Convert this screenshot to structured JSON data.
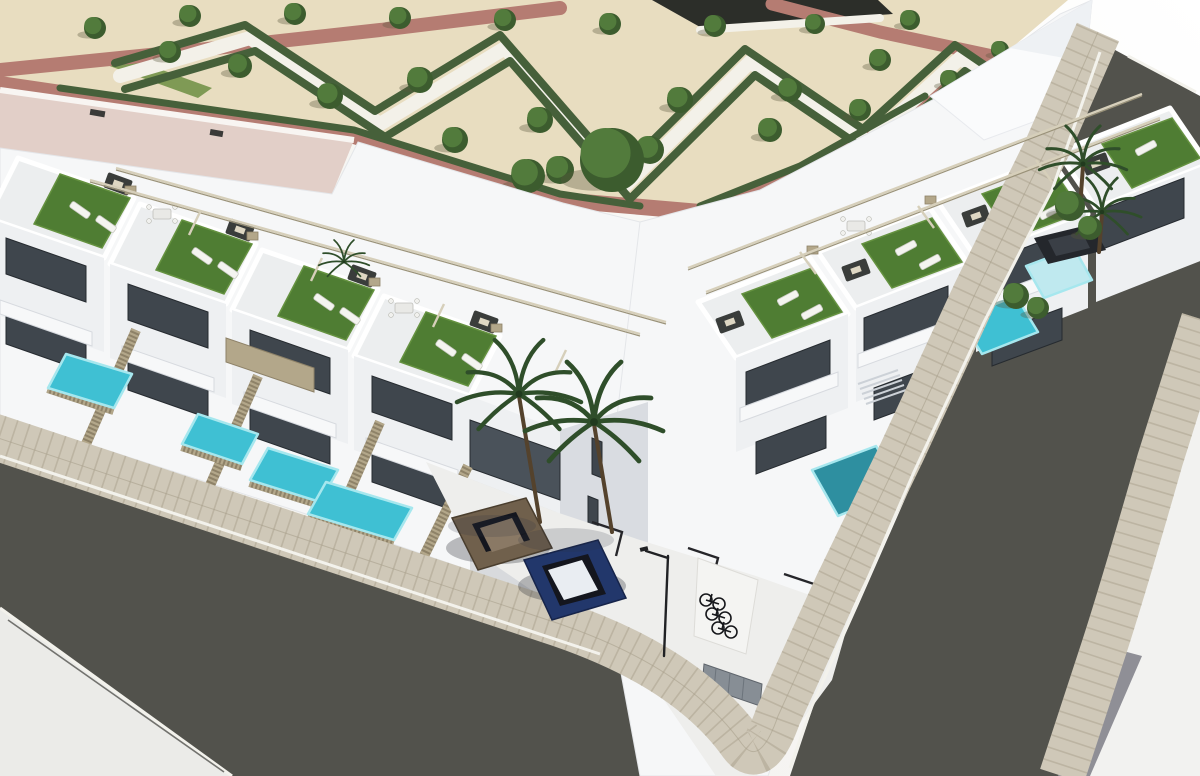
{
  "scene": {
    "type": "architectural-3d-render",
    "setting": "Aerial 3D rendering of a modern white residential complex on a street corner: two-storey townhouses with rooftop terraces, artificial turf, sun loungers and lounge sofas, private plunge pools behind tan slatted fences, a parking court with two cars and a bicycle rack, palm trees, and a landscaped sand-colored park with zigzag hedges, trees and red walking paths. Two asphalt streets with tiled sidewalks meet at the corner.",
    "counts": {
      "rooftop_terraces": 8,
      "pools": 7,
      "cars": 3,
      "palm_trees": 4,
      "bicycles": 3,
      "street_lamps": 1,
      "park_trees": 26
    },
    "objects": [
      "park",
      "zigzag-hedges",
      "red-paths",
      "park-trees",
      "pink-roof-building",
      "left-townhouse-row",
      "right-townhouse-row",
      "corner-building",
      "rooftop-terraces",
      "turf-patches",
      "sun-loungers",
      "lounge-sofas",
      "dining-sets",
      "pergola-rails",
      "private-pools",
      "slatted-fences",
      "balconies",
      "windows",
      "parking-court",
      "parking-markings",
      "blue-car",
      "bronze-car",
      "dark-car",
      "bicycle-rack",
      "street-lamp",
      "left-street",
      "right-street",
      "tiled-sidewalks",
      "corner-sidewalk",
      "palm-trees",
      "street-shrubs"
    ],
    "paths": [
      {
        "p": "0,70 180,52 380,30 560,8",
        "w": 14,
        "cls": "park-path-red"
      },
      {
        "p": "0,84 354,136 560,200 700,212 800,172 928,102 1004,56",
        "w": 16,
        "cls": "park-path-red"
      },
      {
        "p": "772,4 880,32 1002,58",
        "w": 13,
        "cls": "park-path-red"
      },
      {
        "p": "120,76 250,38 380,124 505,48 625,186 750,62 868,142 960,58 1010,92",
        "w": 14,
        "cls": "park-path-white"
      },
      {
        "p": "700,30 880,18",
        "w": 8,
        "cls": "park-path-white"
      }
    ],
    "hedges": [
      {
        "p": "115,63 245,25 375,111 500,35 620,173 745,49 863,129 955,45 1005,79",
        "w": 8
      },
      {
        "p": "125,89 255,51 385,137 510,61 630,199 755,75 873,155 965,71 1015,105",
        "w": 8
      },
      {
        "p": "60,88 354,130 560,194 640,206",
        "w": 7
      },
      {
        "p": "700,206 800,166 925,96",
        "w": 7
      }
    ],
    "trees": [
      [
        95,
        28,
        11
      ],
      [
        190,
        16,
        11
      ],
      [
        295,
        14,
        11
      ],
      [
        400,
        18,
        11
      ],
      [
        505,
        20,
        11
      ],
      [
        610,
        24,
        11
      ],
      [
        715,
        26,
        11
      ],
      [
        815,
        24,
        10
      ],
      [
        910,
        20,
        10
      ],
      [
        170,
        52,
        11
      ],
      [
        240,
        66,
        12
      ],
      [
        330,
        96,
        13
      ],
      [
        420,
        80,
        13
      ],
      [
        455,
        140,
        13
      ],
      [
        540,
        120,
        13
      ],
      [
        560,
        170,
        14
      ],
      [
        650,
        150,
        14
      ],
      [
        680,
        100,
        13
      ],
      [
        770,
        130,
        12
      ],
      [
        790,
        90,
        12
      ],
      [
        860,
        110,
        11
      ],
      [
        880,
        60,
        11
      ],
      [
        950,
        80,
        10
      ],
      [
        1000,
        50,
        9
      ],
      [
        612,
        160,
        32
      ],
      [
        528,
        176,
        17
      ]
    ],
    "trees2": [
      [
        1070,
        206,
        15
      ],
      [
        1090,
        228,
        12
      ],
      [
        1016,
        296,
        13
      ],
      [
        1038,
        308,
        11
      ]
    ],
    "turf": [
      {
        "p": "60,174 130,198 102,248 34,224"
      },
      {
        "p": "182,220 252,244 224,294 156,270"
      },
      {
        "p": "304,266 374,290 346,340 278,316"
      },
      {
        "p": "426,312 496,336 468,386 400,362"
      },
      {
        "p": "742,294 812,268 842,312 772,338"
      },
      {
        "p": "862,244 932,218 962,262 892,288"
      },
      {
        "p": "982,194 1052,168 1082,212 1012,238"
      },
      {
        "p": "1102,144 1172,118 1200,158 1132,188"
      }
    ],
    "loungers": [
      [
        80,
        210,
        35
      ],
      [
        106,
        224,
        35
      ],
      [
        202,
        256,
        35
      ],
      [
        228,
        270,
        35
      ],
      [
        324,
        302,
        35
      ],
      [
        350,
        316,
        35
      ],
      [
        446,
        348,
        35
      ],
      [
        472,
        362,
        35
      ],
      [
        788,
        298,
        -28
      ],
      [
        812,
        312,
        -28
      ],
      [
        906,
        248,
        -28
      ],
      [
        930,
        262,
        -28
      ],
      [
        1026,
        198,
        -28
      ],
      [
        1050,
        212,
        -28
      ],
      [
        1146,
        148,
        -28
      ]
    ],
    "sofas": [
      [
        118,
        184,
        20
      ],
      [
        240,
        230,
        20
      ],
      [
        362,
        276,
        20
      ],
      [
        484,
        322,
        20
      ],
      [
        730,
        322,
        -20
      ],
      [
        856,
        270,
        -20
      ],
      [
        976,
        216,
        -20
      ],
      [
        1096,
        164,
        -20
      ]
    ],
    "windows": [
      {
        "p": "6,238 86,266 86,302 6,274"
      },
      {
        "p": "128,284 208,312 208,348 128,320"
      },
      {
        "p": "250,330 330,358 330,394 250,366"
      },
      {
        "p": "372,376 452,404 452,440 372,412"
      },
      {
        "p": "6,312 86,340 86,372 6,344"
      },
      {
        "p": "128,358 208,386 208,418 128,390"
      },
      {
        "p": "250,404 330,432 330,464 250,436"
      },
      {
        "p": "372,450 452,478 452,510 372,482"
      },
      {
        "p": "470,420 560,452 560,500 470,468",
        "cls": "glass"
      },
      {
        "p": "592,438 602,442 602,478 592,474"
      },
      {
        "p": "588,496 598,500 598,534 588,530"
      },
      {
        "p": "746,372 830,340 830,380 746,412"
      },
      {
        "p": "864,318 948,286 948,326 864,358"
      },
      {
        "p": "982,264 1066,232 1066,272 982,304"
      },
      {
        "p": "1100,210 1184,178 1184,218 1100,250"
      },
      {
        "p": "756,442 826,416 826,448 756,474"
      },
      {
        "p": "874,388 944,362 944,394 874,420"
      },
      {
        "p": "992,334 1062,308 1062,340 992,366"
      }
    ],
    "pools": [
      {
        "p": "66,354 132,374 114,408 48,388"
      },
      {
        "p": "198,414 258,434 242,464 182,444"
      },
      {
        "p": "268,448 338,470 320,502 250,480"
      },
      {
        "p": "326,482 412,508 394,540 308,514"
      },
      {
        "p": "812,470 876,446 902,490 838,516",
        "cls": "teal"
      },
      {
        "p": "960,318 1016,296 1038,332 982,354"
      },
      {
        "p": "1026,266 1074,248 1092,280 1044,298",
        "cls": "pale"
      }
    ],
    "fences": [
      [
        136,
        330,
        86,
        444
      ],
      [
        258,
        376,
        208,
        490
      ],
      [
        380,
        422,
        330,
        536
      ],
      [
        468,
        466,
        424,
        556
      ],
      [
        48,
        388,
        114,
        410
      ],
      [
        182,
        446,
        242,
        466
      ],
      [
        250,
        482,
        320,
        504
      ],
      [
        308,
        516,
        394,
        542
      ]
    ],
    "rails": [
      [
        90,
        180,
        640,
        334
      ],
      [
        116,
        168,
        666,
        322
      ],
      [
        706,
        292,
        1160,
        118
      ],
      [
        688,
        268,
        1142,
        94
      ]
    ],
    "shadows": [
      {
        "p": "0,420 552,602 536,616 0,436",
        "o": 0.13
      },
      {
        "p": "470,548 636,602 606,640 470,580",
        "o": 0.15
      },
      {
        "p": "1086,56 1098,62 1022,206 950,330 882,476 824,612 788,706 770,760 756,752 786,700 822,606 880,472 948,326 1018,202",
        "o": 0.12
      },
      {
        "p": "426,462 556,512 548,524 420,474",
        "o": 0.1
      }
    ]
  },
  "palette": {
    "bg": "#fbfbf9",
    "sand": "#e8ddc0",
    "pathred": "#b57c72",
    "pathwhite": "#f3f1e9",
    "hedge": "#46603a",
    "grass": "#7f9a55",
    "tree": "#527b3c",
    "treedark": "#3c5c2e",
    "trunk": "#54422c",
    "roofpink": "#e2cfc8",
    "roofedge": "#f8f5f2",
    "bldg": "#f6f7f8",
    "facelight": "#eef0f2",
    "faceshade": "#d9dce1",
    "terrace": "#eceeef",
    "window": "#3f464d",
    "windowline": "#262b30",
    "glass": "#4a525a",
    "turf": "#4f7d33",
    "turflight": "#659240",
    "pool": "#3fc0d3",
    "poollight": "#a6e7ee",
    "poolteal": "#2e8fa0",
    "poolpale": "#bfe9ef",
    "road": "#52524c",
    "pave": "#ebebe8",
    "walk": "#cfc8b8",
    "walkline": "#a9a08c",
    "curb": "#f3f2ec",
    "gutter": "#3e3f3a",
    "graystrip": "#8f8f96",
    "fence": "#b3a78a",
    "fencedark": "#8e8268",
    "rail": "#d6cfba",
    "raildark": "#9a9279",
    "sofa": "#3a3d3b",
    "cushion": "#ded7c3",
    "lounger": "#f4f4f0",
    "dining": "#e9e9e6",
    "palm": "#2f4e2a",
    "palmdark": "#213a1e",
    "carblue": "#22376b",
    "carglass": "#14161e",
    "carroof": "#e9edf2",
    "carbronze": "#70604c",
    "carbronzedark": "#4a3e2e",
    "cardark": "#24272c",
    "metal": "#1f2022",
    "niche": "#f4f4f2",
    "doorgray": "#878e95",
    "shadowbase": "#2e3440"
  }
}
